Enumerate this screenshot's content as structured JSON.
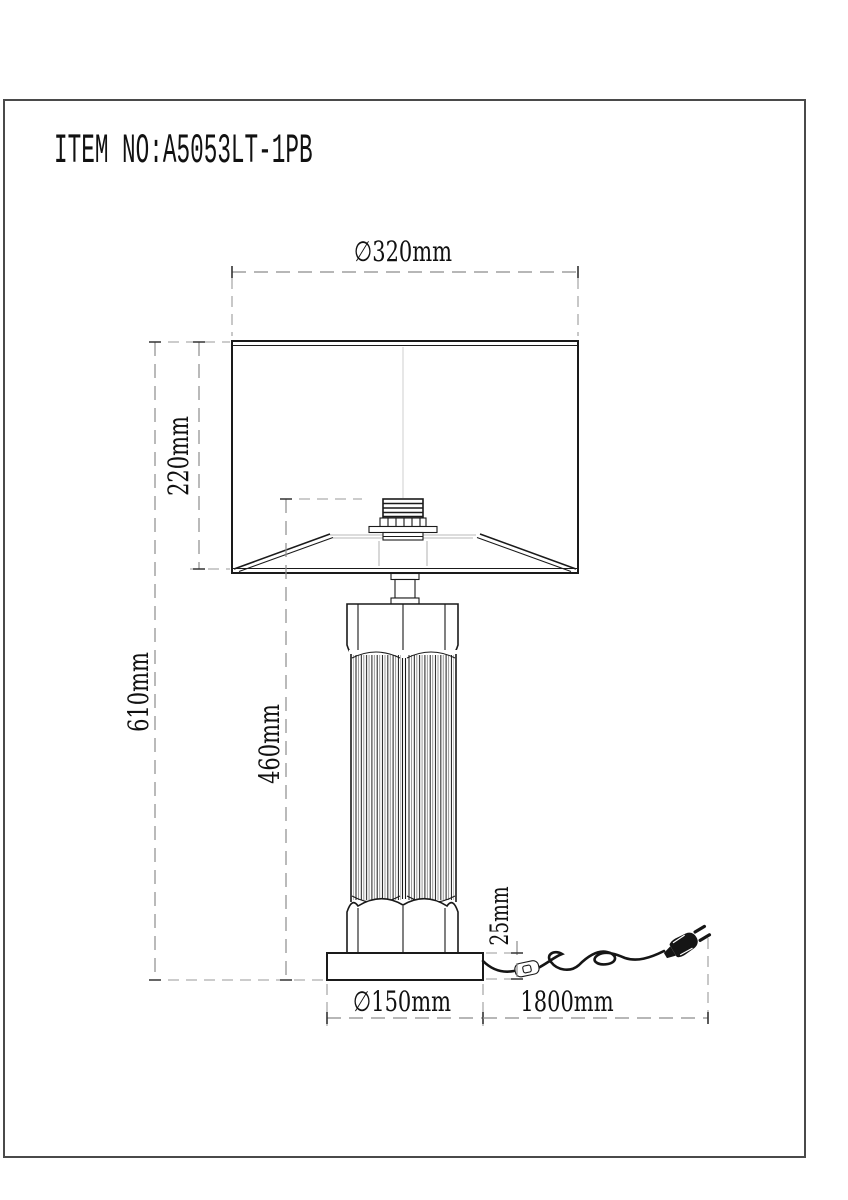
{
  "header": {
    "item_no": "ITEM NO:A5053LT-1PB"
  },
  "dimensions": {
    "shade_diameter": "∅320mm",
    "shade_height": "220mm",
    "total_height": "610mm",
    "body_height": "460mm",
    "base_height": "25mm",
    "base_diameter": "∅150mm",
    "cord_length": "1800mm"
  },
  "colors": {
    "outline": "#1a1a1a",
    "dimension_line": "#8c8c8c",
    "hidden_line": "#b8b8b8",
    "text": "#111111",
    "background": "#ffffff"
  }
}
